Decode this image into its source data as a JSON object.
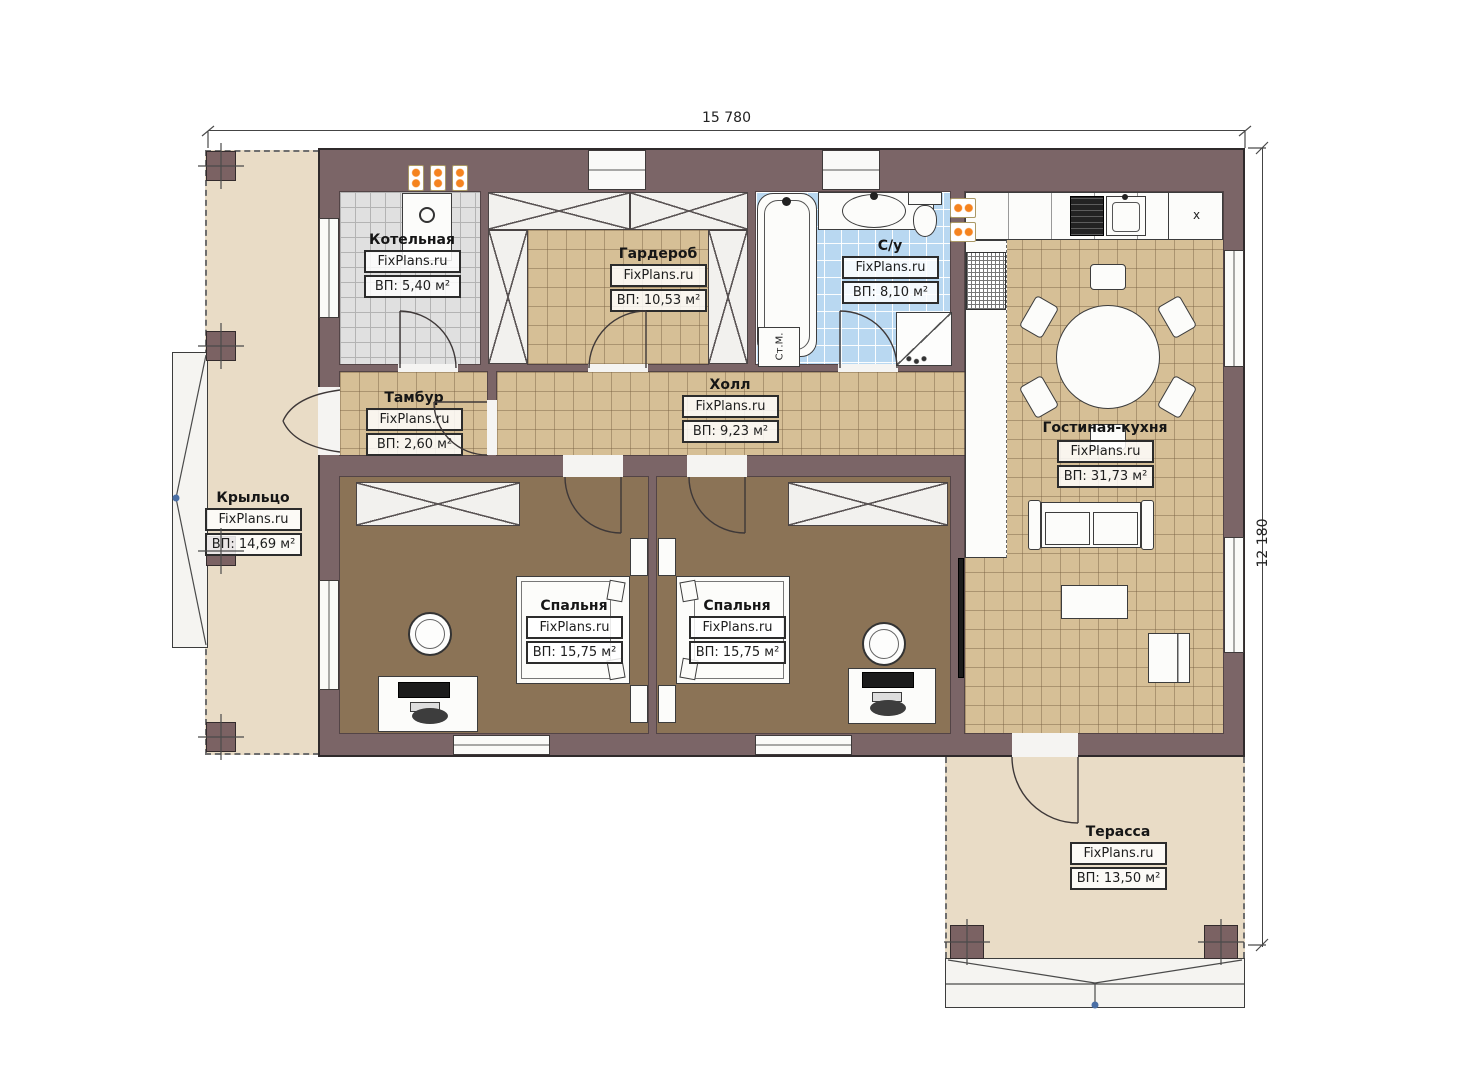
{
  "brand": "FixPlans.ru",
  "dimensions": {
    "width": "15 780",
    "height": "12 180"
  },
  "rooms": [
    {
      "name": "Котельная",
      "area": "ВП: 5,40 м²"
    },
    {
      "name": "Гардероб",
      "area": "ВП: 10,53 м²"
    },
    {
      "name": "С/у",
      "area": "ВП: 8,10 м²"
    },
    {
      "name": "Тамбур",
      "area": "ВП: 2,60 м²"
    },
    {
      "name": "Холл",
      "area": "ВП: 9,23 м²"
    },
    {
      "name": "Гостиная-кухня",
      "area": "ВП: 31,73 м²"
    },
    {
      "name": "Крыльцо",
      "area": "ВП: 14,69 м²"
    },
    {
      "name": "Спальня",
      "area": "ВП: 15,75 м²"
    },
    {
      "name": "Спальня",
      "area": "ВП: 15,75 м²"
    },
    {
      "name": "Терасса",
      "area": "ВП: 13,50 м²"
    }
  ],
  "annotations": {
    "washing_machine": "Ст.М.",
    "kitchen_vent": "x"
  },
  "colors": {
    "wall": "#7b6567",
    "tile_tan": "#d6bf96",
    "tile_gray": "#e0e0e0",
    "tile_blue": "#b9d8f1",
    "bedroom_floor": "#8b7356",
    "outdoor": "#e9dcc6",
    "accent_orange": "#f5831f"
  }
}
